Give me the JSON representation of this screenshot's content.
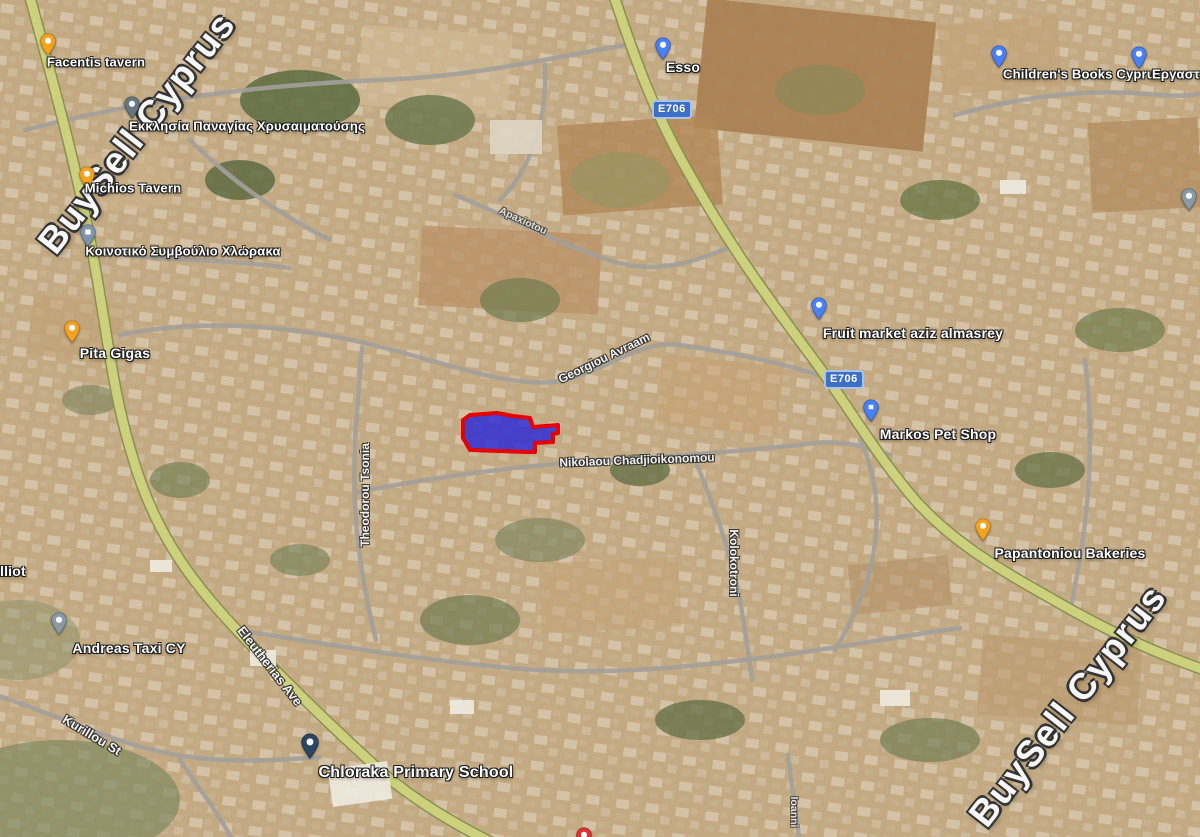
{
  "watermark": {
    "text": "BuySell Cyprus"
  },
  "route_badge": {
    "label": "E706"
  },
  "pois": {
    "facentis": {
      "label": "Facentis tavern",
      "pin": "yellow"
    },
    "church": {
      "label": "Εκκλησία Παναγίας Χρυσαιματούσης",
      "pin": "slate"
    },
    "michios": {
      "label": "Michios Tavern",
      "pin": "yellow"
    },
    "council": {
      "label": "Κοινοτικό Συμβούλιο Χλώρακα",
      "pin": "steel-blue"
    },
    "esso": {
      "label": "Esso",
      "pin": "blue"
    },
    "childrens_books": {
      "label": "Children's Books Cyprus",
      "pin": "blue"
    },
    "ergastiri": {
      "label": "Εργαστήρι",
      "pin": "blue"
    },
    "pita_gigas": {
      "label": "Pita Gigas",
      "pin": "yellow"
    },
    "fruit_market": {
      "label": "Fruit market aziz almasrey",
      "pin": "blue"
    },
    "markos_pet_shop": {
      "label": "Markos Pet Shop",
      "pin": "blue"
    },
    "papantoniou": {
      "label": "Papantoniou Bakeries",
      "pin": "yellow"
    },
    "elliot_partial": {
      "label": "lliot"
    },
    "andreas_taxi": {
      "label": "Andreas Taxi CY",
      "pin": "gray"
    },
    "primary_school": {
      "label": "Chloraka Primary School",
      "pin": "navy"
    }
  },
  "streets": {
    "georgiou": "Georgiou Avraam",
    "nikolaou": "Nikolaou Chadjioikonomou",
    "theodorou": "Theodorou Tsonia",
    "kolokotroni": "Kolokotroni",
    "eleutherias": "Eleutherias Ave",
    "kurillou": "Kurillou St",
    "apaxiotou": "Apaxiotou",
    "ioanni": "Ioanni"
  },
  "plot_highlight": {
    "fill": "#2626d8",
    "stroke": "#e60000"
  },
  "colors": {
    "pin_yellow": "#f5a31f",
    "pin_blue": "#4a80f5",
    "pin_gray": "#8b99a5",
    "pin_navy": "#2c4764",
    "pin_red": "#e03131",
    "badge_blue": "#3d6fc4",
    "road_yellow": "#c9cc79"
  }
}
